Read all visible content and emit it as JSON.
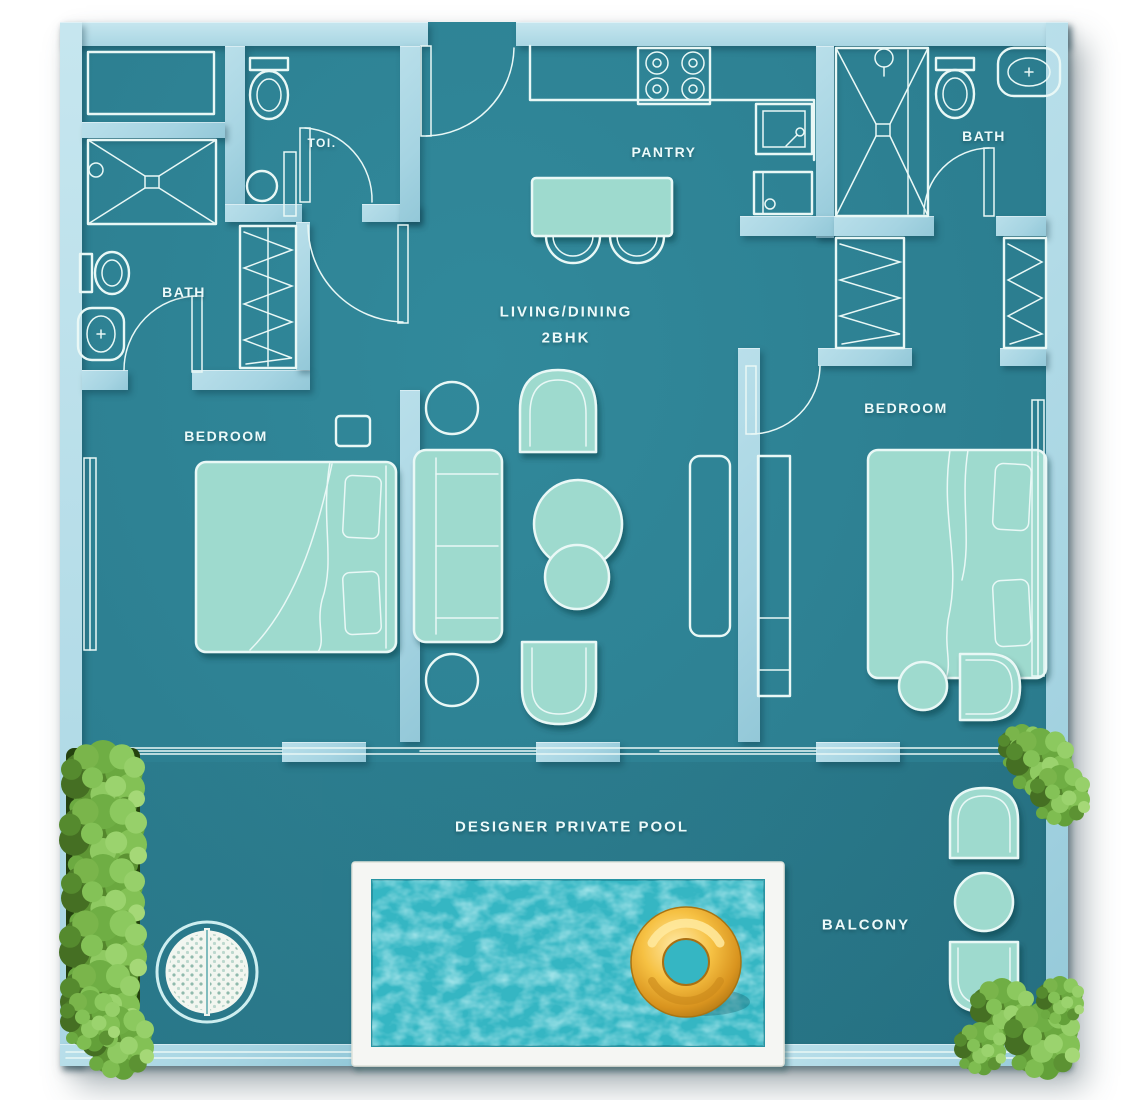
{
  "labels": {
    "toilet": "TOI.",
    "bath_left": "BATH",
    "pantry": "PANTRY",
    "bath_right": "BATH",
    "bedroom_left": "BEDROOM",
    "living_dining": "LIVING/DINING",
    "unit_type": "2BHK",
    "bedroom_right": "BEDROOM",
    "pool": "DESIGNER PRIVATE POOL",
    "balcony": "BALCONY"
  },
  "colors": {
    "page_bg": "#ffffff",
    "floor": "#2d8092",
    "wall": "#a6d4e2",
    "wall_light": "#c6e6ef",
    "line": "#e9f8f6",
    "furn": "#9edace",
    "text": "#ecfafa",
    "pool_water": "#35b6c3",
    "pool_deck": "#f5f6f3",
    "ring_gold": "#f0b42e",
    "plant": "#6aa83f"
  }
}
